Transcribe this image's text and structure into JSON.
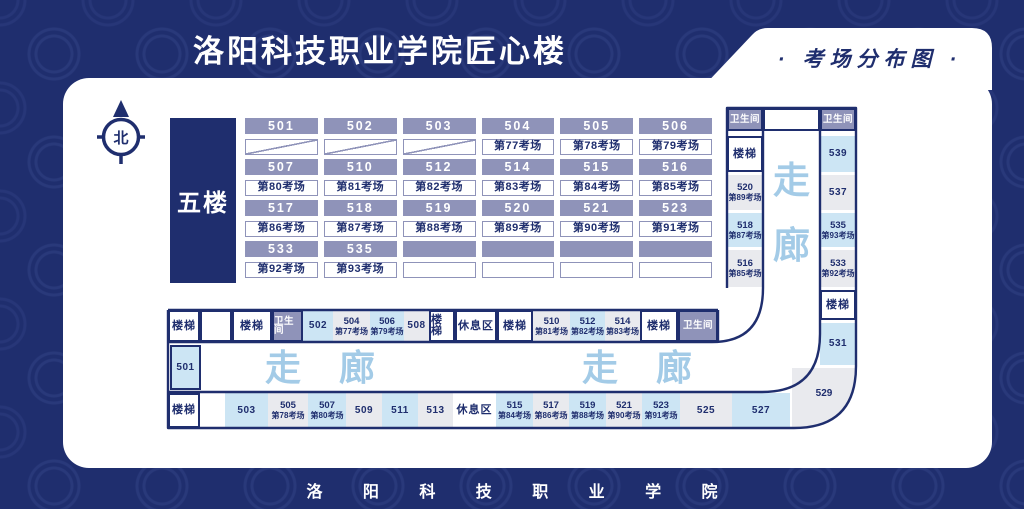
{
  "meta": {
    "title": "洛阳科技职业学院匠心楼",
    "badge": "· 考场分布图 ·",
    "footer": "洛 阳 科 技 职 业 学 院",
    "floor": "五楼",
    "compass": "北"
  },
  "colors": {
    "navy": "#1f2e6e",
    "header_gray": "#8f93b9",
    "light_blue": "#cce5f4",
    "light_gray": "#e9eaee",
    "corridor_blue": "#a3cbe7"
  },
  "main_grid": {
    "groups": [
      {
        "rooms": [
          "501",
          "502",
          "503",
          "504",
          "505",
          "506"
        ],
        "exams": [
          null,
          null,
          null,
          "第77考场",
          "第78考场",
          "第79考场"
        ]
      },
      {
        "rooms": [
          "507",
          "510",
          "512",
          "514",
          "515",
          "516"
        ],
        "exams": [
          "第80考场",
          "第81考场",
          "第82考场",
          "第83考场",
          "第84考场",
          "第85考场"
        ]
      },
      {
        "rooms": [
          "517",
          "518",
          "519",
          "520",
          "521",
          "523"
        ],
        "exams": [
          "第86考场",
          "第87考场",
          "第88考场",
          "第89考场",
          "第90考场",
          "第91考场"
        ]
      },
      {
        "rooms": [
          "533",
          "535",
          "",
          "",
          "",
          ""
        ],
        "exams": [
          "第92考场",
          "第93考场",
          "",
          "",
          "",
          ""
        ]
      }
    ]
  },
  "right_wing": {
    "top_row": [
      {
        "label": "卫生间",
        "type": "toilet"
      },
      {
        "label": "",
        "type": "blank"
      },
      {
        "label": "卫生间",
        "type": "toilet"
      }
    ],
    "inner_col": [
      {
        "label": "楼梯",
        "type": "stair"
      },
      {
        "room": "520",
        "exam": "第89考场",
        "shade": "gray"
      },
      {
        "room": "518",
        "exam": "第87考场",
        "shade": "blue"
      },
      {
        "room": "516",
        "exam": "第85考场",
        "shade": "gray"
      }
    ],
    "outer_col": [
      {
        "room": "539",
        "shade": "blue"
      },
      {
        "room": "537",
        "shade": "gray"
      },
      {
        "room": "535",
        "exam": "第93考场",
        "shade": "blue"
      },
      {
        "room": "533",
        "exam": "第92考场",
        "shade": "gray"
      },
      {
        "label": "楼梯",
        "type": "stair"
      },
      {
        "room": "531",
        "shade": "blue"
      }
    ],
    "corner_room": {
      "room": "529",
      "shade": "gray"
    },
    "corridor_vertical": "走廊"
  },
  "bottom_wing": {
    "top_row": [
      {
        "label": "楼梯",
        "type": "stair"
      },
      {
        "label": "",
        "type": "blank"
      },
      {
        "label": "楼梯",
        "type": "stair"
      },
      {
        "label": "卫生间",
        "type": "toilet"
      },
      {
        "room": "502",
        "shade": "blue"
      },
      {
        "room": "504",
        "exam": "第77考场",
        "shade": "gray"
      },
      {
        "room": "506",
        "exam": "第79考场",
        "shade": "blue"
      },
      {
        "room": "508",
        "shade": "gray"
      },
      {
        "label": "楼梯",
        "type": "stair"
      },
      {
        "label": "休息区",
        "type": "rest"
      },
      {
        "label": "楼梯",
        "type": "stair"
      },
      {
        "room": "510",
        "exam": "第81考场",
        "shade": "gray"
      },
      {
        "room": "512",
        "exam": "第82考场",
        "shade": "blue"
      },
      {
        "room": "514",
        "exam": "第83考场",
        "shade": "gray"
      },
      {
        "label": "楼梯",
        "type": "stair"
      },
      {
        "label": "卫生间",
        "type": "toilet"
      }
    ],
    "middle_room": {
      "room": "501",
      "shade": "blue"
    },
    "corridor_labels": [
      "走 廊",
      "走 廊"
    ],
    "bottom_row": [
      {
        "label": "楼梯",
        "type": "stair"
      },
      {
        "room": "503",
        "shade": "blue"
      },
      {
        "room": "505",
        "exam": "第78考场",
        "shade": "gray"
      },
      {
        "room": "507",
        "exam": "第80考场",
        "shade": "blue"
      },
      {
        "room": "509",
        "shade": "gray"
      },
      {
        "room": "511",
        "shade": "blue"
      },
      {
        "room": "513",
        "shade": "gray"
      },
      {
        "label": "休息区",
        "type": "rest2"
      },
      {
        "room": "515",
        "exam": "第84考场",
        "shade": "blue"
      },
      {
        "room": "517",
        "exam": "第86考场",
        "shade": "gray"
      },
      {
        "room": "519",
        "exam": "第88考场",
        "shade": "blue"
      },
      {
        "room": "521",
        "exam": "第90考场",
        "shade": "gray"
      },
      {
        "room": "523",
        "exam": "第91考场",
        "shade": "blue"
      },
      {
        "room": "525",
        "shade": "gray"
      },
      {
        "room": "527",
        "shade": "blue"
      }
    ]
  }
}
